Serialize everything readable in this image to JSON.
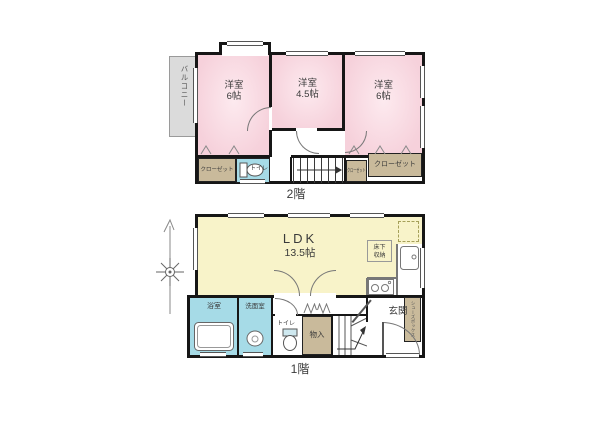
{
  "floors": {
    "f2": {
      "title": "2階",
      "balcony": "バルコニー",
      "rooms": {
        "left": {
          "name": "洋室",
          "size": "6帖"
        },
        "middle": {
          "name": "洋室",
          "size": "4.5帖"
        },
        "right": {
          "name": "洋室",
          "size": "6帖"
        }
      },
      "closet_left": "クローゼット",
      "closet_small": "クローゼット",
      "closet_right": "クローゼット",
      "toilet": "トイレ"
    },
    "f1": {
      "title": "1階",
      "ldk": {
        "name": "LDK",
        "size": "13.5帖"
      },
      "underfloor_storage": "床下収納",
      "bathroom": "浴室",
      "washroom": "洗面室",
      "toilet": "トイレ",
      "storage": "物入",
      "entrance": "玄関",
      "shoe_box": "シューズボックス"
    }
  },
  "colors": {
    "room_pink": "#f6d1db",
    "ldk_yellow": "#f8f3c9",
    "water_blue": "#a6dbe7",
    "closet_tan": "#c9ba9b",
    "balcony_gray": "#dbdbdb",
    "wall_black": "#161616"
  }
}
